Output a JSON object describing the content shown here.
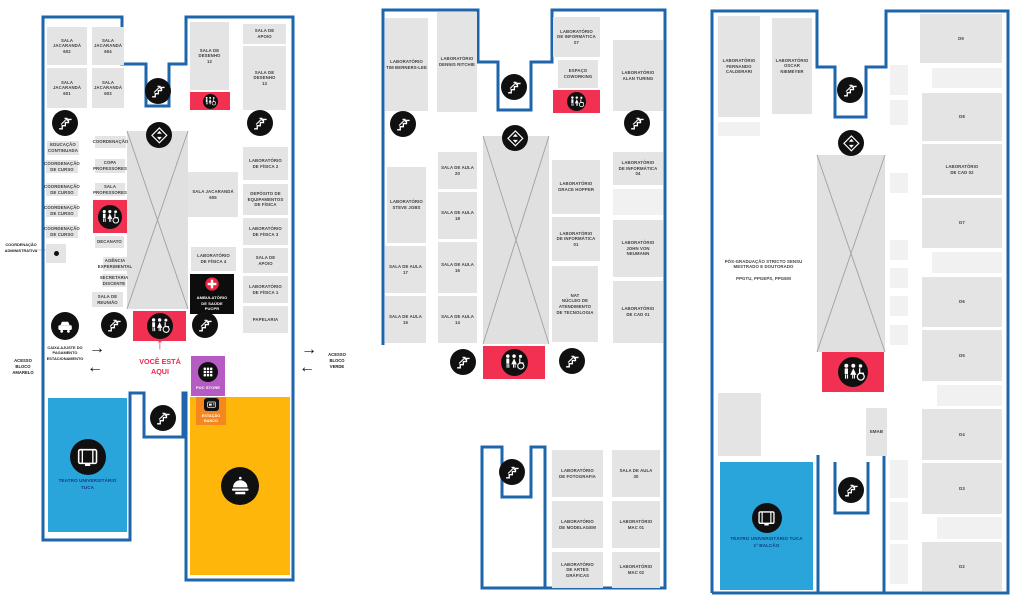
{
  "colors": {
    "outline": "#1d66ab",
    "room": "#e4e4e4",
    "room_light": "#f1f1f1",
    "hall": "#e0e0e0",
    "hall_line": "#a0a0a0",
    "restroom_red": "#f23052",
    "marker_black": "#101010",
    "theater_blue": "#2aa5dc",
    "theater_text": "#123c7e",
    "food_yellow": "#ffb60a",
    "store_purple": "#b55bc3",
    "atm_orange": "#f6871f",
    "medical_black": "#0d0d0d",
    "accent_red": "#f0274b",
    "text_dark": "#3f3f3f",
    "cross_red": "#e8243f"
  },
  "maps": [
    {
      "name": "floor-plan-1",
      "paths": [
        "M43,345 V17 H122 V64 H146 V106 H169 V64 H186 V17 H293 V580 H186 V393 H183 V437 H144 V393 H130 V540 H43 V345"
      ],
      "aux_lines": [
        "M36,250 H52"
      ],
      "halls": [
        {
          "x": 127,
          "y": 131,
          "w": 61,
          "h": 178
        }
      ],
      "rooms": [
        {
          "x": 47,
          "y": 27,
          "w": 40,
          "h": 38,
          "label": "SALA\nJACARANDÁ\n602"
        },
        {
          "x": 92,
          "y": 27,
          "w": 32,
          "h": 38,
          "label": "SALA\nJACARANDÁ\n604"
        },
        {
          "x": 47,
          "y": 68,
          "w": 40,
          "h": 40,
          "label": "SALA\nJACARANDÁ\n601"
        },
        {
          "x": 92,
          "y": 68,
          "w": 32,
          "h": 40,
          "label": "SALA\nJACARANDÁ\n603"
        },
        {
          "x": 190,
          "y": 22,
          "w": 39,
          "h": 68,
          "label": "SALA DE\nDESENHO\n12"
        },
        {
          "x": 243,
          "y": 24,
          "w": 43,
          "h": 20,
          "label": "SALA DE\nAPOIO"
        },
        {
          "x": 243,
          "y": 46,
          "w": 43,
          "h": 64,
          "label": "SALA DE\nDESENHO\n13"
        },
        {
          "x": 47,
          "y": 141,
          "w": 32,
          "h": 14,
          "label": "EDUCAÇÃO\nCONTINUADA"
        },
        {
          "x": 46,
          "y": 160,
          "w": 32,
          "h": 13,
          "label": "COORDENAÇÃO\nDE CURSO"
        },
        {
          "x": 46,
          "y": 183,
          "w": 32,
          "h": 13,
          "label": "COORDENAÇÃO\nDE CURSO"
        },
        {
          "x": 46,
          "y": 204,
          "w": 32,
          "h": 13,
          "label": "COORDENAÇÃO\nDE CURSO"
        },
        {
          "x": 46,
          "y": 225,
          "w": 32,
          "h": 13,
          "label": "COORDENAÇÃO\nDE CURSO"
        },
        {
          "x": 95,
          "y": 136,
          "w": 31,
          "h": 12,
          "label": "COORDENAÇÃO"
        },
        {
          "x": 95,
          "y": 159,
          "w": 30,
          "h": 14,
          "label": "COPA\nPROFESSORES"
        },
        {
          "x": 95,
          "y": 183,
          "w": 30,
          "h": 13,
          "label": "SALA\nPROFESSORES"
        },
        {
          "x": 95,
          "y": 236,
          "w": 29,
          "h": 12,
          "label": "DECANATO"
        },
        {
          "x": 103,
          "y": 257,
          "w": 24,
          "h": 14,
          "label": "AGÊNCIA\nEXPERIMENTAL"
        },
        {
          "x": 102,
          "y": 274,
          "w": 24,
          "h": 13,
          "label": "SECRETARIA\nDISCENTE"
        },
        {
          "x": 92,
          "y": 292,
          "w": 31,
          "h": 15,
          "label": "SALA DE\nREUNIÃO"
        },
        {
          "x": 188,
          "y": 172,
          "w": 50,
          "h": 45,
          "label": "SALA JACARANDÁ\n605"
        },
        {
          "x": 243,
          "y": 147,
          "w": 45,
          "h": 33,
          "label": "LABORATÓRIO\nDE FÍSICA 2"
        },
        {
          "x": 243,
          "y": 184,
          "w": 45,
          "h": 31,
          "label": "DEPÓSITO DE\nEQUIPAMENTOS\nDE FÍSICA"
        },
        {
          "x": 243,
          "y": 218,
          "w": 45,
          "h": 27,
          "label": "LABORATÓRIO\nDE FÍSICA 3"
        },
        {
          "x": 243,
          "y": 248,
          "w": 45,
          "h": 25,
          "label": "SALA DE\nAPOIO"
        },
        {
          "x": 243,
          "y": 276,
          "w": 45,
          "h": 27,
          "label": "LABORATÓRIO\nDE FÍSICA 1"
        },
        {
          "x": 243,
          "y": 306,
          "w": 45,
          "h": 27,
          "label": "PAPELARIA"
        },
        {
          "x": 191,
          "y": 247,
          "w": 45,
          "h": 24,
          "label": "LABORATÓRIO\nDE FÍSICA 4"
        }
      ],
      "restrooms": [
        {
          "x": 190,
          "y": 92,
          "w": 40,
          "h": 18,
          "d": 15
        },
        {
          "x": 93,
          "y": 200,
          "w": 34,
          "h": 33,
          "d": 24
        },
        {
          "x": 133,
          "y": 311,
          "w": 53,
          "h": 30,
          "d": 26
        }
      ],
      "features": [
        {
          "type": "food",
          "x": 190,
          "y": 397,
          "w": 100,
          "h": 178,
          "label": ""
        },
        {
          "type": "theater",
          "x": 48,
          "y": 398,
          "w": 79,
          "h": 134,
          "label": "TEATRO UNIVERSITÁRIO\nTUCA"
        },
        {
          "type": "medical",
          "x": 190,
          "y": 274,
          "w": 44,
          "h": 40,
          "label": "AMBULATÓRIO\nDE SAÚDE\nPUCPR"
        },
        {
          "type": "store",
          "x": 191,
          "y": 356,
          "w": 34,
          "h": 40,
          "label": "PUC STORE"
        },
        {
          "type": "atm",
          "x": 196,
          "y": 397,
          "w": 30,
          "h": 28,
          "label": "ESTAÇÃO\nBANCO"
        },
        {
          "type": "dot",
          "x": 46,
          "y": 244,
          "w": 20,
          "h": 19,
          "label": ""
        }
      ],
      "markers": [
        {
          "icon": "stairs",
          "cx": 65,
          "cy": 123,
          "d": 26
        },
        {
          "icon": "stairs",
          "cx": 158,
          "cy": 91,
          "d": 26
        },
        {
          "icon": "stairs",
          "cx": 260,
          "cy": 123,
          "d": 26
        },
        {
          "icon": "elevator",
          "cx": 159,
          "cy": 135,
          "d": 26
        },
        {
          "icon": "stairs",
          "cx": 114,
          "cy": 325,
          "d": 26
        },
        {
          "icon": "stairs",
          "cx": 205,
          "cy": 325,
          "d": 26
        },
        {
          "icon": "stairs",
          "cx": 163,
          "cy": 418,
          "d": 26
        },
        {
          "icon": "car",
          "cx": 65,
          "cy": 326,
          "d": 28
        }
      ]
    },
    {
      "name": "floor-plan-2",
      "paths": [
        "M383,345 V10 H478 V62 H498 V110 H531 V62 H552 V10 H665 V588 H482 V447 H502 V497 H531 V447 H545 V588"
      ],
      "aux_lines": [],
      "halls": [
        {
          "x": 483,
          "y": 136,
          "w": 66,
          "h": 208
        }
      ],
      "rooms": [
        {
          "x": 385,
          "y": 18,
          "w": 43,
          "h": 93,
          "label": "LABORATÓRIO\nTIM BERNERS-LEE"
        },
        {
          "x": 437,
          "y": 12,
          "w": 40,
          "h": 100,
          "label": "LABORATÓRIO\nDENNIS RITCHIE"
        },
        {
          "x": 553,
          "y": 17,
          "w": 47,
          "h": 40,
          "label": "LABORATÓRIO\nDE INFORMÁTICA\n07"
        },
        {
          "x": 558,
          "y": 60,
          "w": 40,
          "h": 28,
          "label": "ESPAÇO\nCOWORKING"
        },
        {
          "x": 613,
          "y": 40,
          "w": 50,
          "h": 71,
          "label": "LABORATÓRIO\nALAN TURING"
        },
        {
          "x": 387,
          "y": 167,
          "w": 39,
          "h": 76,
          "label": "LABORATÓRIO\nSTEVE JOBS"
        },
        {
          "x": 385,
          "y": 246,
          "w": 41,
          "h": 47,
          "label": "SALA DE AULA\n17"
        },
        {
          "x": 385,
          "y": 296,
          "w": 41,
          "h": 47,
          "label": "SALA DE AULA\n15"
        },
        {
          "x": 438,
          "y": 152,
          "w": 39,
          "h": 37,
          "label": "SALA DE AULA\n20"
        },
        {
          "x": 438,
          "y": 192,
          "w": 39,
          "h": 47,
          "label": "SALA DE AULA\n18"
        },
        {
          "x": 438,
          "y": 242,
          "w": 39,
          "h": 51,
          "label": "SALA DE AULA\n16"
        },
        {
          "x": 438,
          "y": 296,
          "w": 39,
          "h": 47,
          "label": "SALA DE AULA\n14"
        },
        {
          "x": 552,
          "y": 160,
          "w": 48,
          "h": 54,
          "label": "LABORATÓRIO\nGRACE HOPPER"
        },
        {
          "x": 552,
          "y": 217,
          "w": 48,
          "h": 44,
          "label": "LABORATÓRIO\nDE INFORMÁTICA\n01"
        },
        {
          "x": 552,
          "y": 266,
          "w": 46,
          "h": 76,
          "label": "NAT\nNÚCLEO DE\nATENDIMENTO\nDE TECNOLOGIA"
        },
        {
          "x": 613,
          "y": 152,
          "w": 50,
          "h": 33,
          "label": "LABORATÓRIO\nDE INFORMÁTICA\n04"
        },
        {
          "x": 613,
          "y": 189,
          "w": 50,
          "h": 26,
          "type": "light"
        },
        {
          "x": 613,
          "y": 220,
          "w": 50,
          "h": 57,
          "label": "LABORATÓRIO\nJOHN VON\nNEUMANN"
        },
        {
          "x": 613,
          "y": 281,
          "w": 50,
          "h": 62,
          "label": "LABORATÓRIO\nDE CAD 01"
        },
        {
          "x": 552,
          "y": 450,
          "w": 51,
          "h": 47,
          "label": "LABORATÓRIO\nDE FOTOGRAFIA"
        },
        {
          "x": 612,
          "y": 450,
          "w": 48,
          "h": 47,
          "label": "SALA DE AULA\n30"
        },
        {
          "x": 552,
          "y": 501,
          "w": 51,
          "h": 47,
          "label": "LABORATÓRIO\nDE MODELAGEM"
        },
        {
          "x": 612,
          "y": 501,
          "w": 48,
          "h": 47,
          "label": "LABORATÓRIO\nMAC 01"
        },
        {
          "x": 552,
          "y": 552,
          "w": 51,
          "h": 36,
          "label": "LABORATÓRIO\nDE ARTES\nGRÁFICAS"
        },
        {
          "x": 612,
          "y": 552,
          "w": 48,
          "h": 36,
          "label": "LABORATÓRIO\nMAC 02"
        }
      ],
      "restrooms": [
        {
          "x": 553,
          "y": 90,
          "w": 47,
          "h": 23,
          "d": 19
        },
        {
          "x": 483,
          "y": 346,
          "w": 62,
          "h": 33,
          "d": 27
        }
      ],
      "features": [],
      "markers": [
        {
          "icon": "stairs",
          "cx": 514,
          "cy": 87,
          "d": 26
        },
        {
          "icon": "stairs",
          "cx": 403,
          "cy": 124,
          "d": 26
        },
        {
          "icon": "stairs",
          "cx": 637,
          "cy": 123,
          "d": 26
        },
        {
          "icon": "elevator",
          "cx": 515,
          "cy": 138,
          "d": 26
        },
        {
          "icon": "stairs",
          "cx": 463,
          "cy": 362,
          "d": 26
        },
        {
          "icon": "stairs",
          "cx": 572,
          "cy": 361,
          "d": 26
        },
        {
          "icon": "stairs",
          "cx": 512,
          "cy": 472,
          "d": 26
        }
      ]
    },
    {
      "name": "floor-plan-3",
      "paths": [
        "M712,593 V11 H817 V67 H835 V117 H866 V67 H886 V11 H1008 V593 H712",
        "M818,455 V593",
        "M884,455 V593",
        "M835,462 V513 H868 V462"
      ],
      "aux_lines": [],
      "halls": [
        {
          "x": 817,
          "y": 155,
          "w": 68,
          "h": 197
        }
      ],
      "rooms": [
        {
          "x": 718,
          "y": 16,
          "w": 42,
          "h": 101,
          "label": "LABORATÓRIO\nFERNANDO\nCALDERARI"
        },
        {
          "x": 772,
          "y": 18,
          "w": 40,
          "h": 96,
          "label": "LABORATÓRIO\nOSCAR\nNIEMEYER"
        },
        {
          "x": 718,
          "y": 122,
          "w": 42,
          "h": 14,
          "type": "light"
        },
        {
          "x": 715,
          "y": 155,
          "w": 97,
          "h": 230,
          "type": "text",
          "label": "PÓS-GRADUAÇÃO STRICTO SENSU\nMESTRADO E DOUTORADO\n\nPPGTU, PPGEPS, PPGEM"
        },
        {
          "x": 718,
          "y": 393,
          "w": 43,
          "h": 63
        },
        {
          "x": 890,
          "y": 65,
          "w": 18,
          "h": 30,
          "type": "light"
        },
        {
          "x": 890,
          "y": 100,
          "w": 18,
          "h": 25,
          "type": "light"
        },
        {
          "x": 890,
          "y": 173,
          "w": 18,
          "h": 20,
          "type": "light"
        },
        {
          "x": 890,
          "y": 240,
          "w": 18,
          "h": 20,
          "type": "light"
        },
        {
          "x": 890,
          "y": 268,
          "w": 18,
          "h": 20,
          "type": "light"
        },
        {
          "x": 890,
          "y": 296,
          "w": 18,
          "h": 20,
          "type": "light"
        },
        {
          "x": 890,
          "y": 325,
          "w": 18,
          "h": 20,
          "type": "light"
        },
        {
          "x": 890,
          "y": 460,
          "w": 18,
          "h": 38,
          "type": "light"
        },
        {
          "x": 890,
          "y": 502,
          "w": 18,
          "h": 38,
          "type": "light"
        },
        {
          "x": 890,
          "y": 544,
          "w": 18,
          "h": 40,
          "type": "light"
        },
        {
          "x": 866,
          "y": 408,
          "w": 21,
          "h": 48,
          "label": "EMAB"
        },
        {
          "x": 920,
          "y": 14,
          "w": 82,
          "h": 49,
          "label": "D9"
        },
        {
          "x": 932,
          "y": 68,
          "w": 70,
          "h": 20,
          "type": "light"
        },
        {
          "x": 922,
          "y": 93,
          "w": 80,
          "h": 48,
          "label": "D8"
        },
        {
          "x": 922,
          "y": 144,
          "w": 80,
          "h": 51,
          "label": "LABORATÓRIO\nDE CAD 02"
        },
        {
          "x": 922,
          "y": 198,
          "w": 80,
          "h": 50,
          "label": "D7"
        },
        {
          "x": 932,
          "y": 252,
          "w": 70,
          "h": 21,
          "type": "light"
        },
        {
          "x": 922,
          "y": 277,
          "w": 80,
          "h": 50,
          "label": "D6"
        },
        {
          "x": 922,
          "y": 330,
          "w": 80,
          "h": 51,
          "label": "D5"
        },
        {
          "x": 937,
          "y": 385,
          "w": 65,
          "h": 21,
          "type": "light"
        },
        {
          "x": 922,
          "y": 409,
          "w": 80,
          "h": 51,
          "label": "D4"
        },
        {
          "x": 922,
          "y": 463,
          "w": 80,
          "h": 51,
          "label": "D3"
        },
        {
          "x": 937,
          "y": 517,
          "w": 65,
          "h": 22,
          "type": "light"
        },
        {
          "x": 922,
          "y": 542,
          "w": 80,
          "h": 49,
          "label": "D2"
        }
      ],
      "restrooms": [
        {
          "x": 822,
          "y": 352,
          "w": 62,
          "h": 40,
          "d": 30
        }
      ],
      "features": [
        {
          "type": "theater",
          "x": 720,
          "y": 462,
          "w": 93,
          "h": 128,
          "label": "TEATRO UNIVERSITÁRIO TUCA\n1º BALCÃO"
        }
      ],
      "markers": [
        {
          "icon": "stairs",
          "cx": 850,
          "cy": 90,
          "d": 26
        },
        {
          "icon": "elevator",
          "cx": 851,
          "cy": 143,
          "d": 26
        },
        {
          "icon": "stairs",
          "cx": 851,
          "cy": 490,
          "d": 26
        }
      ]
    }
  ],
  "annotations": [
    {
      "name": "you-are-here-arrow",
      "x": 150,
      "y": 336,
      "w": 20,
      "h": 18,
      "text": "↑",
      "color": "#f0274b",
      "size": 16,
      "weight": 800
    },
    {
      "name": "you-are-here-label",
      "x": 128,
      "y": 357,
      "w": 64,
      "h": 20,
      "text": "VOCÊ ESTÁ\nAQUI",
      "color": "#f0274b",
      "size": 7.2,
      "weight": 800
    },
    {
      "name": "access-label-west",
      "x": 2,
      "y": 355,
      "w": 42,
      "h": 24,
      "text": "ACESSO\nBLOCO\nAMARELO",
      "color": "#1a1a1a",
      "size": 4.2
    },
    {
      "name": "arrow-right-icon",
      "x": 82,
      "y": 340,
      "w": 30,
      "h": 18,
      "text": "→",
      "color": "#111111",
      "size": 16
    },
    {
      "name": "arrow-left-icon",
      "x": 80,
      "y": 359,
      "w": 30,
      "h": 18,
      "text": "←",
      "color": "#111111",
      "size": 16
    },
    {
      "name": "arrow-right-icon",
      "x": 294,
      "y": 341,
      "w": 30,
      "h": 18,
      "text": "→",
      "color": "#111111",
      "size": 16
    },
    {
      "name": "arrow-left-icon",
      "x": 292,
      "y": 359,
      "w": 30,
      "h": 18,
      "text": "←",
      "color": "#111111",
      "size": 16
    },
    {
      "name": "access-label-east",
      "x": 318,
      "y": 348,
      "w": 38,
      "h": 26,
      "text": "ACESSO\nBLOCO\nVERDE",
      "color": "#1a1a1a",
      "size": 4.2
    },
    {
      "name": "parking-kiosk-label",
      "x": 38,
      "y": 343,
      "w": 54,
      "h": 20,
      "text": "CAIXA AJUSTE DO\nPAGAMENTO\nESTACIONAMENTO",
      "color": "#222222",
      "size": 3.9
    },
    {
      "name": "admin-coordination-label",
      "x": 1,
      "y": 241,
      "w": 40,
      "h": 13,
      "text": "COORDENAÇÃO\nADMINISTRATIVA",
      "color": "#222222",
      "size": 3.9
    }
  ]
}
